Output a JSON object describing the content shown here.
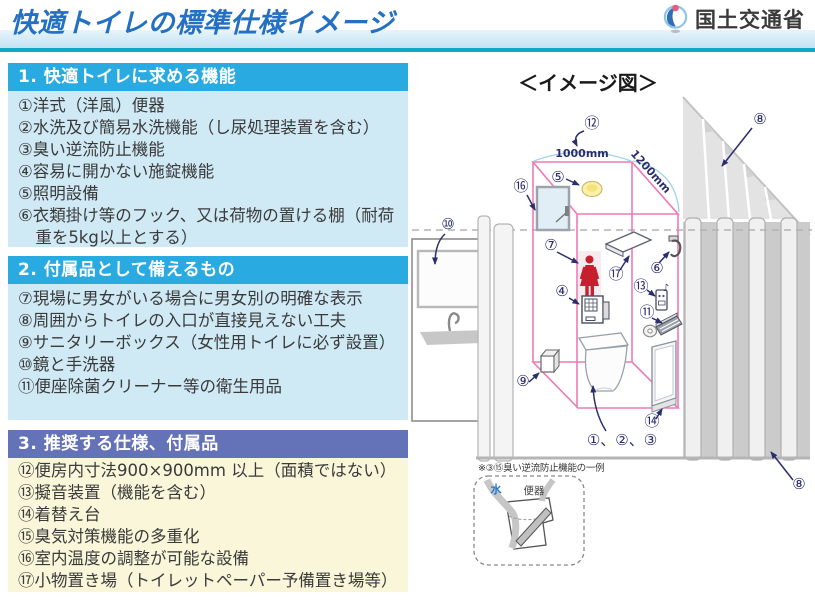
{
  "header": {
    "title": "快適トイレの標準仕様イメージ",
    "ministry": "国土交通省"
  },
  "sections": [
    {
      "header": "1. 快適トイレに求める機能",
      "items": [
        "①洋式（洋風）便器",
        "②水洗及び簡易水洗機能（し尿処理装置を含む）",
        "③臭い逆流防止機能",
        "④容易に開かない施錠機能",
        "⑤照明設備",
        "⑥衣類掛け等のフック、又は荷物の置ける棚（耐荷重を5kg以上とする）"
      ]
    },
    {
      "header": "2. 付属品として備えるもの",
      "items": [
        "⑦現場に男女がいる場合に男女別の明確な表示",
        "⑧周囲からトイレの入口が直接見えない工夫",
        "⑨サニタリーボックス（女性用トイレに必ず設置）",
        "⑩鏡と手洗器",
        "⑪便座除菌クリーナー等の衛生用品"
      ]
    },
    {
      "header": "3. 推奨する仕様、付属品",
      "items": [
        "⑫便房内寸法900×900mm 以上（面積ではない）",
        "⑬擬音装置（機能を含む）",
        "⑭着替え台",
        "⑮臭気対策機能の多重化",
        "⑯室内温度の調整が可能な設備",
        "⑰小物置き場（トイレットペーパー予備置き場等）"
      ]
    }
  ],
  "diagram": {
    "title": "＜イメージ図＞",
    "dimensions": {
      "width": "1000mm",
      "depth": "1200mm"
    },
    "callouts": {
      "dimension": "⑫",
      "light": "⑤",
      "window": "⑯",
      "mirror": "⑩",
      "sign": "⑦",
      "lock": "④",
      "shelf": "⑰",
      "hook": "⑥",
      "sound": "⑬",
      "cleaner": "⑪",
      "sanitary_box": "⑨",
      "changing": "⑭",
      "fence_top": "⑧",
      "fence_bottom": "⑧",
      "toilet": "①、②、③",
      "music_note": "♪"
    },
    "inset": {
      "note": "※③⑮臭い逆流防止機能の一例",
      "water": "水",
      "toilet": "便器"
    }
  },
  "colors": {
    "title_blue": "#2470c2",
    "teal_rule": "#12a7c4",
    "section_header_blue": "#29abe2",
    "section_header_purple": "#6472b8",
    "section_body_blue": "#cfe9f5",
    "section_body_cream": "#faf6d9",
    "booth_pink": "#ef7ab5",
    "floor_yellow": "#f8f4ca",
    "callout_navy": "#2b2e6e",
    "sign_red": "#c4202e"
  }
}
